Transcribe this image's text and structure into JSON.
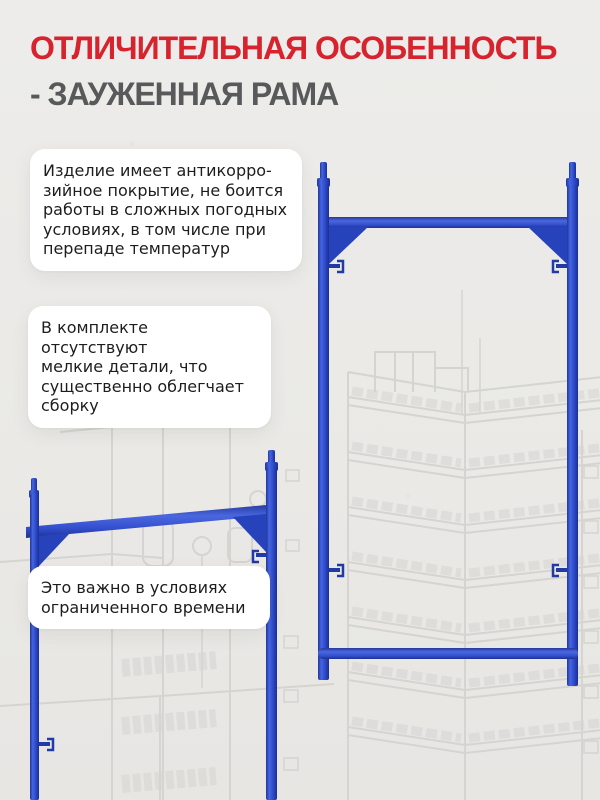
{
  "header": {
    "title": "ОТЛИЧИТЕЛЬНАЯ ОСОБЕННОСТЬ",
    "subtitle": "- ЗАУЖЕННАЯ РАМА"
  },
  "features": [
    {
      "text": "Изделие имеет антикорро-\nзийное покрытие, не боится\nработы в сложных погодных\nусловиях, в том числе при\nперепаде температур"
    },
    {
      "text": "В комплекте отсутствуют\nмелкие детали, что\nсущественно облегчает\nсборку"
    },
    {
      "text": "Это важно в условиях\nограниченного времени"
    }
  ],
  "illustration": {
    "main_image": "scaffold-narrowed-frame",
    "secondary_image": "scaffold-narrowed-frame-partial",
    "background": "city-buildings-line-sketch"
  },
  "colors": {
    "accent_red": "#d6232e",
    "subtitle_gray": "#58595b",
    "frame_blue": "#3653cf",
    "frame_blue_dark": "#1c2f9a",
    "background": "#eae9e6",
    "sketch_gray": "#d5d4d1",
    "card_background": "#ffffff",
    "card_text": "#1d1d1f"
  }
}
